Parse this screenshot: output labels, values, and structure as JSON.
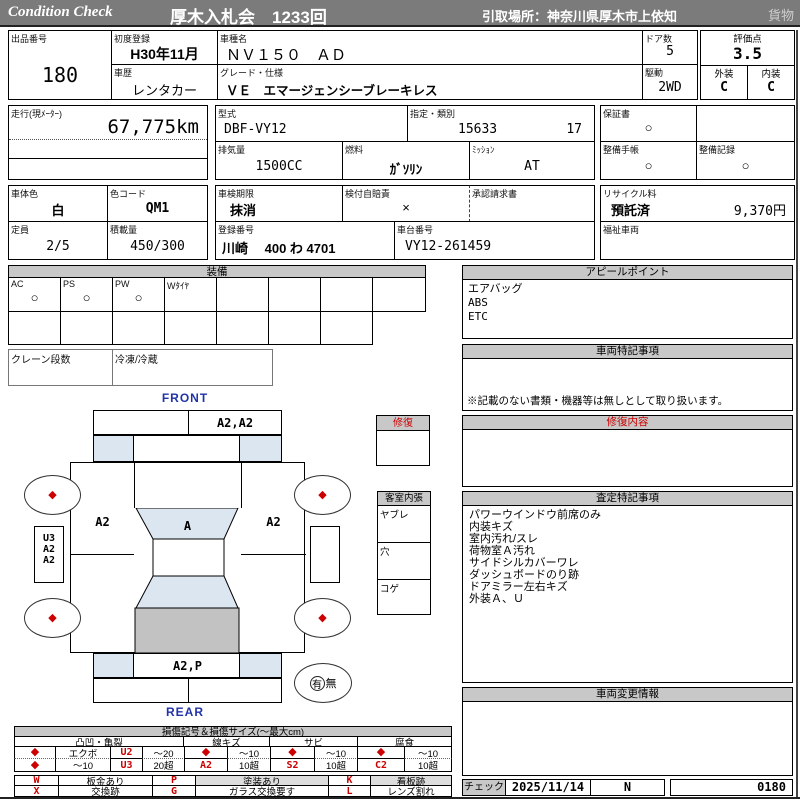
{
  "colors": {
    "red": "#cc0000",
    "hdrgray": "#c8c8c8",
    "bargray": "#7b7b7b",
    "bluefill": "#dce6f1",
    "cargogray": "#c2c2c2",
    "bluetext": "#2233aa",
    "ltgray": "#dddddd"
  },
  "topbar": {
    "brand": "Condition Check",
    "auction": "厚木入札会　1233回",
    "pickup": "引取場所：神奈川県厚木市上依知",
    "category": "貨物"
  },
  "info": {
    "lot_label": "出品番号",
    "lot": "180",
    "first_reg_label": "初度登録",
    "first_reg": "H30年11月",
    "history_label": "車歴",
    "history": "レンタカー",
    "model_name_label": "車種名",
    "model_name": "ＮＶ１５０　ＡＤ",
    "grade_label": "グレード・仕様",
    "grade": "ＶＥ　エマージェンシーブレーキレス",
    "doors_label": "ドア数",
    "doors": "5",
    "drive_label": "駆動",
    "drive": "2WD",
    "score_label": "評価点",
    "score": "3.5",
    "exterior_label": "外装",
    "exterior": "C",
    "interior_label": "内装",
    "interior": "C",
    "mileage_label": "走行(現ﾒｰﾀｰ)",
    "mileage": "67,775km",
    "model_code_label": "型式",
    "model_code": "DBF-VY12",
    "class_label": "指定・類別",
    "class_no": "15633",
    "class_no2": "17",
    "warranty_label": "保証書",
    "warranty": "○",
    "displacement_label": "排気量",
    "displacement": "1500CC",
    "fuel_label": "燃料",
    "fuel": "ｶﾞｿﾘﾝ",
    "transmission_label": "ﾐｯｼｮﾝ",
    "transmission": "AT",
    "maintenance_book_label": "整備手帳",
    "maintenance_book": "○",
    "maintenance_record_label": "整備記録",
    "maintenance_record": "○",
    "body_color_label": "車体色",
    "body_color": "白",
    "color_code_label": "色コード",
    "color_code": "QM1",
    "inspection_label": "車検期限",
    "inspection": "抹消",
    "insurance_label": "検付自賠責",
    "insurance": "×",
    "approval_label": "承認請求書",
    "recycle_label": "リサイクル料",
    "recycle_status": "預託済",
    "recycle_fee": "9,370円",
    "capacity_label": "定員",
    "capacity": "2/5",
    "load_label": "積載量",
    "load": "450/300",
    "reg_no_label": "登録番号",
    "reg_no": "川崎　 400 わ 4701",
    "chassis_label": "車台番号",
    "chassis_no": "VY12-261459",
    "welfare_label": "福祉車両"
  },
  "equipment": {
    "title": "装備",
    "items": [
      {
        "label": "AC",
        "value": "○"
      },
      {
        "label": "PS",
        "value": "○"
      },
      {
        "label": "PW",
        "value": "○"
      },
      {
        "label": "Wﾀｲﾔ",
        "value": ""
      }
    ],
    "crane_label": "クレーン段数",
    "refrigeration_label": "冷凍/冷蔵"
  },
  "panels": {
    "appeal": {
      "title": "アピールポイント",
      "items": [
        "エアバッグ",
        "ABS",
        "ETC"
      ]
    },
    "vehicle_notes": {
      "title": "車両特記事項",
      "note": "※記載のない書類・機器等は無しとして取り扱います。"
    },
    "repair": {
      "title": "修復内容"
    },
    "assessment": {
      "title": "査定特記事項",
      "items": [
        "パワーウインドウ前席のみ",
        "内装キズ",
        "室内汚れ/スレ",
        "荷物室Ａ汚れ",
        "サイドシルカバーワレ",
        "ダッシュボードのり跡",
        "ドアミラー左右キズ",
        "外装Ａ、Ｕ"
      ]
    },
    "change": {
      "title": "車両変更情報"
    }
  },
  "diagram": {
    "front_label": "FRONT",
    "rear_label": "REAR",
    "marker": "◆",
    "front_bumper_right": "A2,A2",
    "left_front_panel": "A2",
    "windshield": "A",
    "right_front_panel": "A2",
    "left_side_marks": [
      "U3",
      "A2",
      "A2"
    ],
    "rear_panel": "A2,P",
    "repair_present": "有",
    "repair_absent": "無",
    "repair_box_title": "修復",
    "interior_title": "客室内張",
    "interior_rows": [
      "ヤブレ",
      "穴",
      "コゲ"
    ]
  },
  "legend": {
    "title": "損傷記号＆損傷サイズ(～最大cm)",
    "groups": [
      {
        "name": "凸凹・亀裂",
        "rows": [
          [
            "◆",
            "エクボ",
            "U2",
            "～20"
          ],
          [
            "◆",
            "～10",
            "U3",
            "20超"
          ]
        ]
      },
      {
        "name": "線キズ",
        "rows": [
          [
            "◆",
            "～10"
          ],
          [
            "A2",
            "10超"
          ]
        ]
      },
      {
        "name": "サビ",
        "rows": [
          [
            "◆",
            "～10"
          ],
          [
            "S2",
            "10超"
          ]
        ]
      },
      {
        "name": "腐食",
        "rows": [
          [
            "◆",
            "～10"
          ],
          [
            "C2",
            "10超"
          ]
        ]
      }
    ],
    "codes": [
      {
        "code": "W",
        "desc": "板金あり"
      },
      {
        "code": "X",
        "desc": "交換跡"
      },
      {
        "code": "P",
        "desc": "塗装あり"
      },
      {
        "code": "G",
        "desc": "ガラス交換要す"
      },
      {
        "code": "K",
        "desc": "看板跡"
      },
      {
        "code": "L",
        "desc": "レンズ割れ"
      }
    ]
  },
  "check": {
    "label": "チェック",
    "date": "2025/11/14",
    "inspector": "N",
    "number": "0180"
  }
}
